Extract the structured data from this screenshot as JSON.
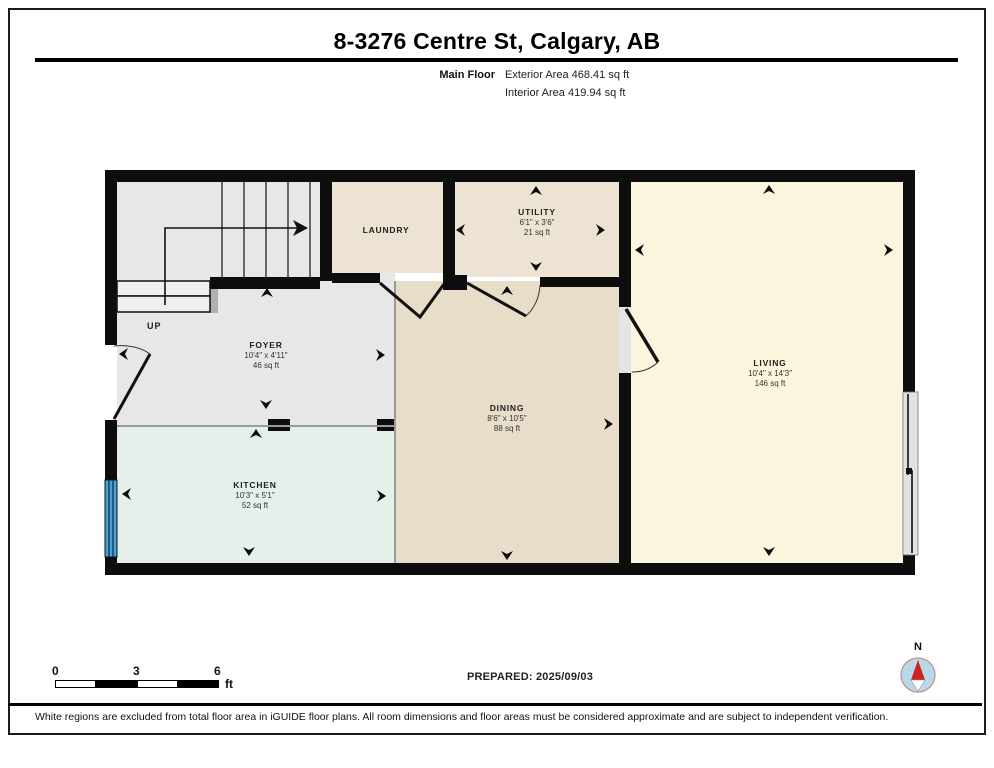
{
  "header": {
    "title": "8-3276 Centre St, Calgary, AB",
    "floor_label": "Main Floor",
    "exterior_area": "Exterior Area 468.41 sq ft",
    "interior_area": "Interior Area 419.94 sq ft"
  },
  "rooms": [
    {
      "name": "LAUNDRY",
      "dims": "",
      "area": ""
    },
    {
      "name": "UTILITY",
      "dims": "6'1\" x 3'6\"",
      "area": "21 sq ft"
    },
    {
      "name": "FOYER",
      "dims": "10'4\" x 4'11\"",
      "area": "46 sq ft"
    },
    {
      "name": "DINING",
      "dims": "8'6\" x 10'5\"",
      "area": "88 sq ft"
    },
    {
      "name": "LIVING",
      "dims": "10'4\" x 14'3\"",
      "area": "146 sq ft"
    },
    {
      "name": "KITCHEN",
      "dims": "10'3\" x 5'1\"",
      "area": "52 sq ft"
    }
  ],
  "stairs": {
    "direction_label": "UP"
  },
  "footer": {
    "scale": {
      "ticks": [
        "0",
        "3",
        "6"
      ],
      "unit": "ft"
    },
    "prepared": "PREPARED: 2025/09/03",
    "compass_label": "N",
    "disclaimer": "White regions are excluded from total floor area in iGUIDE floor plans. All room dimensions and floor areas must be considered approximate and are subject to independent verification."
  },
  "colors": {
    "wall": "#0d0d0d",
    "foyer_gray": "#e7e7e7",
    "laundry_utility_beige": "#ece3d3",
    "dining_beige": "#e8ddc9",
    "living_yellow": "#faf5dc",
    "kitchen_mint": "#e4f0e9",
    "window_blue": "#4aa3d8",
    "compass_blue": "#b9d8e8",
    "needle_red": "#cc2222"
  }
}
